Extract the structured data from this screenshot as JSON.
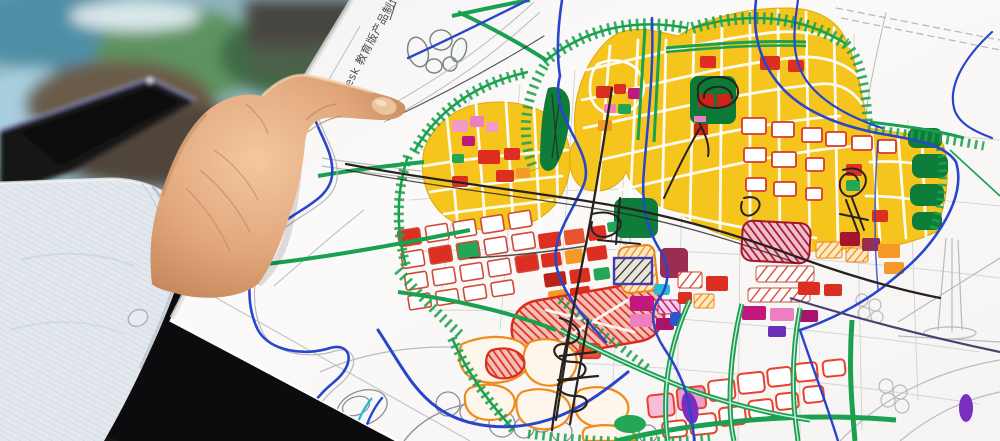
{
  "scene": {
    "type": "photograph",
    "subject": "hand holding a hand-drawn city master-plan marker sketch over a desk",
    "watermark_text": "desk 教育版产品制作",
    "objects": [
      "paper map sketch",
      "human hand",
      "shirt sleeve cuff",
      "tablet on desk",
      "aerial rendering print",
      "black table"
    ]
  },
  "palette": {
    "paper": "#fbfaf9",
    "table_black": "#0c0c0e",
    "sleeve": "#e3e8ee",
    "skin_mid": "#e2a77c",
    "marker_green": "#1ea34f",
    "marker_dark_green": "#0e7d39",
    "marker_yellow": "#f5c41d",
    "marker_red": "#dc2f22",
    "marker_crimson": "#a61430",
    "marker_magenta": "#c2187e",
    "marker_pink": "#f29bc8",
    "marker_orange": "#f59a26",
    "marker_blue": "#2946cb",
    "marker_cyan": "#27bcd4",
    "marker_purple": "#7a2fc0",
    "marker_indigo": "#3f3cb5",
    "pencil_gray": "#b9b9be",
    "ink_black": "#26221f",
    "tablet_body": "#141419",
    "tablet_edge": "#9a9fd6",
    "photo_teal": "#5b93a8",
    "desk_brown": "#6b5c49"
  }
}
